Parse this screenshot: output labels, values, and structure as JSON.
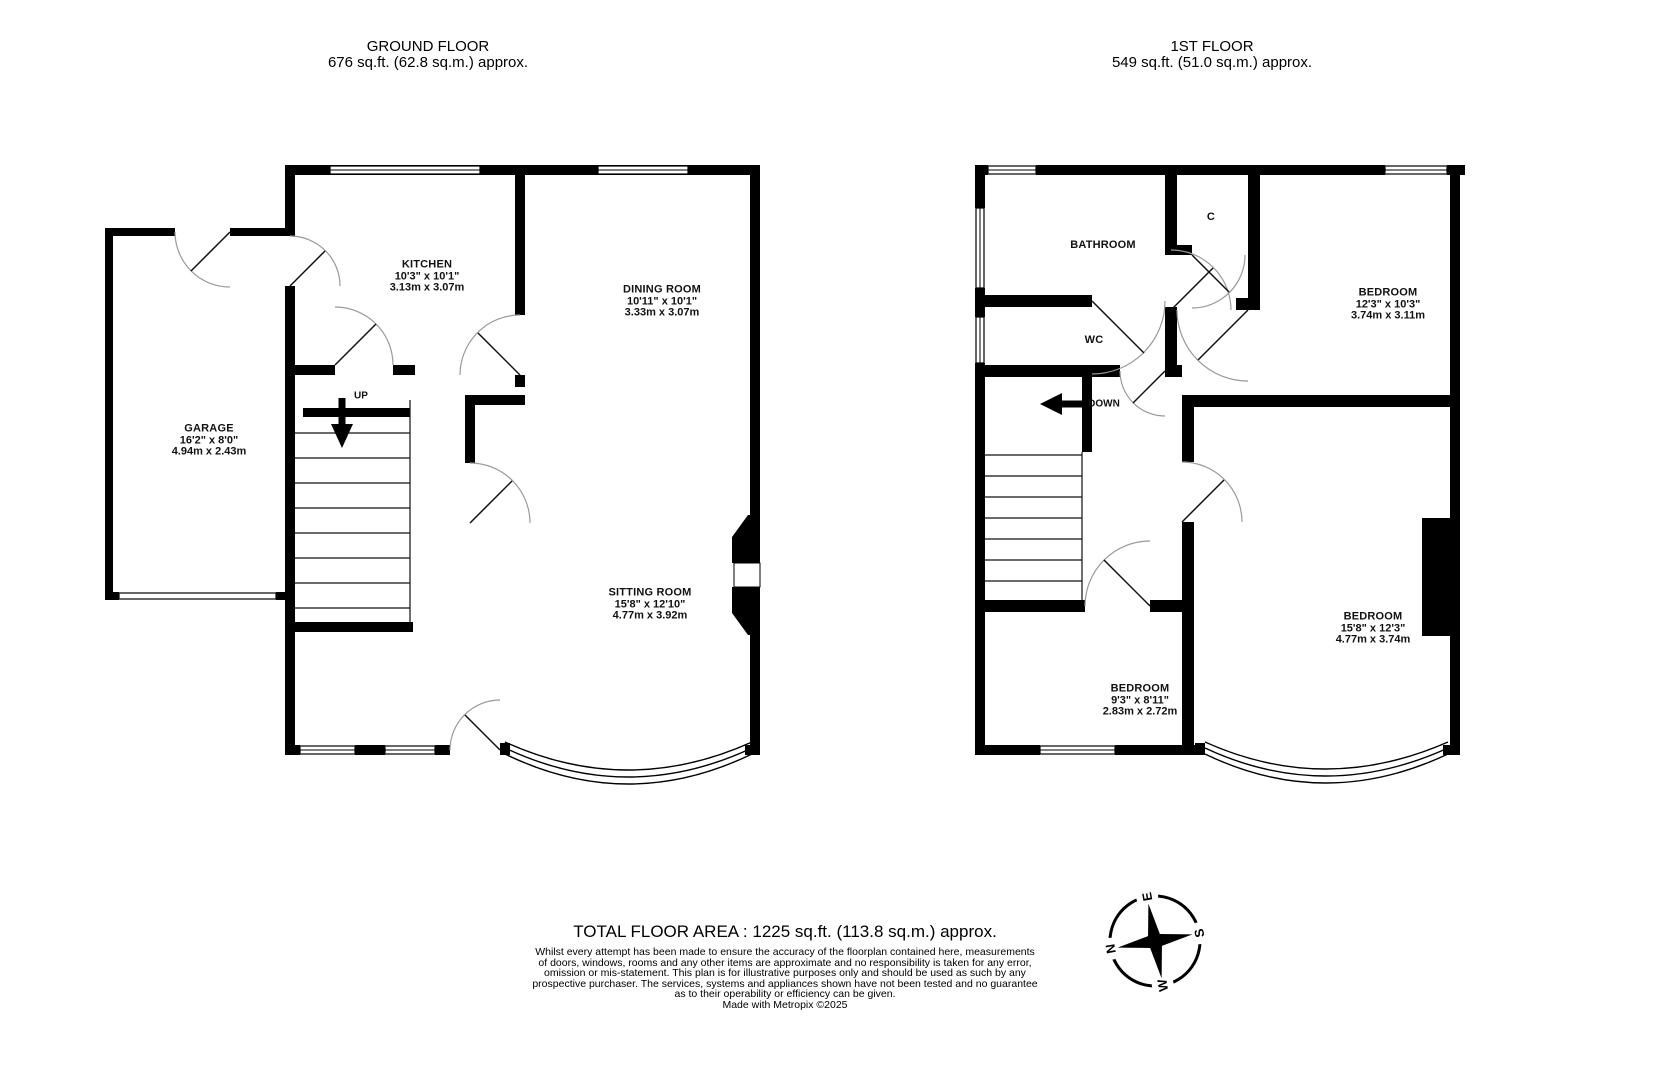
{
  "ground_floor": {
    "title": "GROUND FLOOR",
    "subtitle": "676 sq.ft. (62.8 sq.m.) approx.",
    "stairs_label": "UP",
    "rooms": {
      "kitchen": {
        "name": "KITCHEN",
        "dims_ft": "10'3\"  x 10'1\"",
        "dims_m": "3.13m  x 3.07m"
      },
      "dining": {
        "name": "DINING ROOM",
        "dims_ft": "10'11\"  x 10'1\"",
        "dims_m": "3.33m  x 3.07m"
      },
      "garage": {
        "name": "GARAGE",
        "dims_ft": "16'2\"  x 8'0\"",
        "dims_m": "4.94m  x 2.43m"
      },
      "sitting": {
        "name": "SITTING ROOM",
        "dims_ft": "15'8\"  x 12'10\"",
        "dims_m": "4.77m  x 3.92m"
      }
    }
  },
  "first_floor": {
    "title": "1ST FLOOR",
    "subtitle": "549 sq.ft. (51.0 sq.m.) approx.",
    "stairs_label": "DOWN",
    "rooms": {
      "bathroom": {
        "name": "BATHROOM"
      },
      "wc": {
        "name": "WC"
      },
      "cupboard": {
        "name": "C"
      },
      "bedroom1": {
        "name": "BEDROOM",
        "dims_ft": "12'3\"  x 10'3\"",
        "dims_m": "3.74m  x 3.11m"
      },
      "bedroom2": {
        "name": "BEDROOM",
        "dims_ft": "15'8\"  x 12'3\"",
        "dims_m": "4.77m  x 3.74m"
      },
      "bedroom3": {
        "name": "BEDROOM",
        "dims_ft": "9'3\"  x 8'11\"",
        "dims_m": "2.83m  x 2.72m"
      }
    }
  },
  "footer": {
    "total": "TOTAL FLOOR AREA : 1225 sq.ft. (113.8 sq.m.) approx.",
    "disclaimer_lines": [
      "Whilst every attempt has been made to ensure the accuracy of the floorplan contained here, measurements",
      "of doors, windows, rooms and any other items are approximate and no responsibility is taken for any error,",
      "omission or mis-statement. This plan is for illustrative purposes only and should be used as such by any",
      "prospective purchaser. The services, systems and appliances shown have not been tested and no guarantee",
      "as to their operability or efficiency can be given."
    ],
    "credit": "Made with Metropix ©2025"
  },
  "compass": {
    "n": "N",
    "e": "E",
    "s": "S",
    "w": "W"
  }
}
